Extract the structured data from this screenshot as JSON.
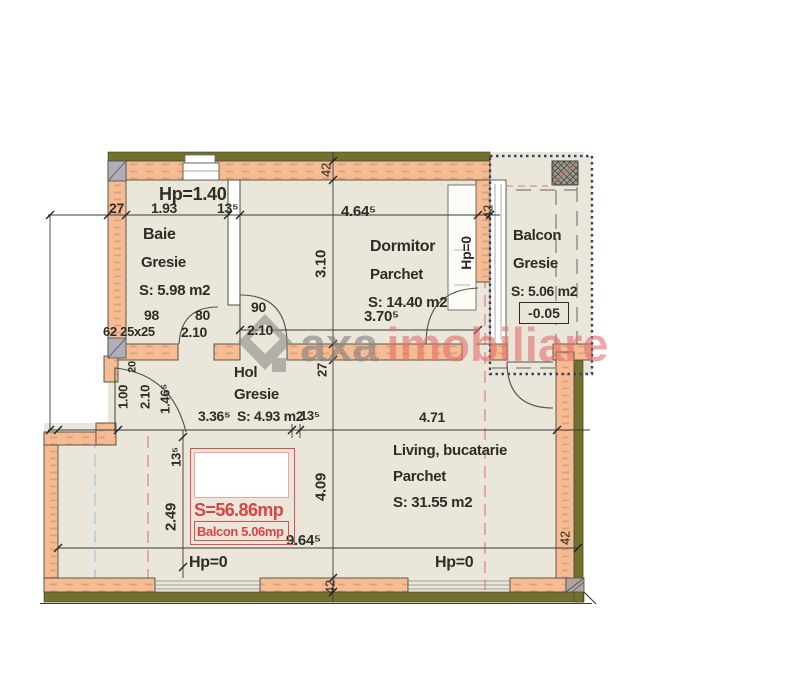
{
  "watermark": {
    "gray_text": "axa",
    "red_text": "imobiliare"
  },
  "rooms": {
    "baie": {
      "name": "Baie",
      "finish": "Gresie",
      "area": "S: 5.98 m2"
    },
    "dormitor": {
      "name": "Dormitor",
      "finish": "Parchet",
      "area": "S: 14.40 m2"
    },
    "balcon": {
      "name": "Balcon",
      "finish": "Gresie",
      "area": "S: 5.06 m2",
      "level": "-0.05"
    },
    "hol": {
      "name": "Hol",
      "finish": "Gresie",
      "area": "S: 4.93 m2"
    },
    "living": {
      "name": "Living, bucatarie",
      "finish": "Parchet",
      "area": "S: 31.55 m2"
    }
  },
  "summary": {
    "total_area": "S=56.86mp",
    "balcony_area": "Balcon 5.06mp"
  },
  "labels": {
    "hp_baie": "Hp=1.40",
    "hp_niche": "Hp=0",
    "hp_bottom_left": "Hp=0",
    "hp_bottom_right": "Hp=0"
  },
  "dims": {
    "baie_wall": "27",
    "baie_width": "1.93",
    "baie_part": "13⁵",
    "dorm_width": "4.64⁵",
    "dorm_depth": "3.10",
    "dorm_inner": "3.70⁵",
    "door_98": "98",
    "door_80": "80",
    "shaft": "62 25x25",
    "door_h_a": "2.10",
    "door_90": "90",
    "door_h_b": "2.10",
    "entry_wall": "20",
    "entry_w": "1.00",
    "entry_h": "2.10",
    "entry_seg": "1.46⁵",
    "hol_width": "3.36⁵",
    "hol_part": "13⁵",
    "living_width": "4.71",
    "wall_mid": "27",
    "balc_seg": "13⁵",
    "balc_depth": "2.49",
    "living_depth": "4.09",
    "total_width": "9.64⁵",
    "wall_42_top": "42",
    "wall_42_niche": "42",
    "wall_42_right": "42",
    "wall_42_bottom": "42"
  },
  "colors": {
    "wall_fill": "#f5bb92",
    "structure_band": "#72722e",
    "room_fill": "#eae6da",
    "accent_red": "#dd4f4f",
    "watermark_gray": "#808080",
    "watermark_red": "#e2716d",
    "section_line_red": "#e58b8b",
    "section_line_blue": "#a9cadf",
    "balcony_border": "#3c3c63"
  }
}
